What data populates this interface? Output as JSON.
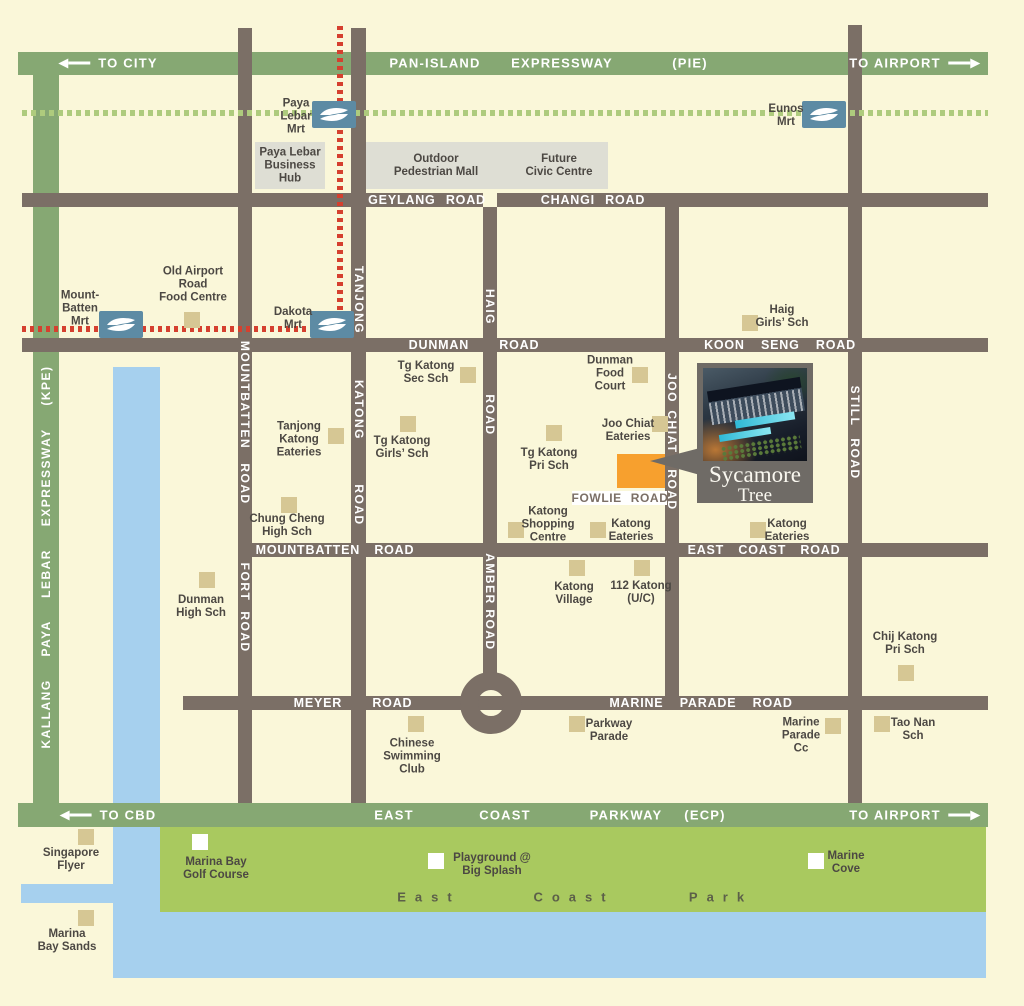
{
  "colors": {
    "background": "#FAF7D9",
    "road": "#7B6F66",
    "expressway_green": "#86A873",
    "mrt_line_green": "#AECB7D",
    "mrt_line_red": "#D5402F",
    "water": "#A6D0EE",
    "park": "#A9C95F",
    "landmark_beige": "#D6C794",
    "site_orange": "#F7A02E",
    "mrt_icon_blue": "#5D8BA4",
    "area_gray": "#DEDED4",
    "callout_gray": "#6F6B66",
    "label_dark": "#4C4843"
  },
  "expressways": {
    "pie": {
      "to_city": "TO CITY",
      "name_a": "PAN-ISLAND",
      "name_b": "EXPRESSWAY",
      "abbr": "(PIE)",
      "to_airport": "TO AIRPORT"
    },
    "ecp": {
      "to_cbd": "TO CBD",
      "name_a": "EAST",
      "name_b": "COAST",
      "name_c": "PARKWAY",
      "abbr": "(ECP)",
      "to_airport": "TO AIRPORT"
    },
    "kpe": {
      "name": "KALLANG PAYA LEBAR EXPRESSWAY (KPE)"
    }
  },
  "roads": {
    "geylang": "GEYLANG ROAD",
    "changi": "CHANGI ROAD",
    "dunman": "DUNMAN ROAD",
    "koon_seng": "KOON SENG ROAD",
    "mountbatten_h": "MOUNTBATTEN ROAD",
    "east_coast": "EAST COAST ROAD",
    "meyer": "MEYER ROAD",
    "marine_parade": "MARINE PARADE ROAD",
    "fowlie": "FOWLIE ROAD",
    "mountbatten_v": [
      "MOUNTBATTEN",
      "ROAD"
    ],
    "fort": [
      "FORT",
      "ROAD"
    ],
    "tanjong_katong": [
      "TANJONG",
      "KATONG",
      "ROAD"
    ],
    "haig": [
      "HAIG",
      "ROAD"
    ],
    "joo_chiat": [
      "JOO",
      "CHIAT",
      "ROAD"
    ],
    "still": [
      "STILL",
      "ROAD"
    ],
    "amber": [
      "AMBER",
      "ROAD"
    ]
  },
  "mrt": {
    "paya_lebar": "Paya\nLebar\nMrt",
    "eunos": "Eunos\nMrt",
    "mountbatten": "Mount-\nBatten\nMrt",
    "dakota": "Dakota\nMrt"
  },
  "areas": {
    "business_hub": "Paya Lebar\nBusiness\nHub",
    "pedestrian_mall": "Outdoor\nPedestrian Mall",
    "civic_centre": "Future\nCivic Centre",
    "park_east": "East",
    "park_coast": "Coast",
    "park_park": "Park"
  },
  "landmarks": {
    "old_airport": "Old Airport\nRoad\nFood Centre",
    "haig_girls": "Haig\nGirls’ Sch",
    "tg_katong_sec": "Tg Katong\nSec Sch",
    "dunman_food_court": "Dunman\nFood\nCourt",
    "tanjong_katong_eateries": "Tanjong\nKatong\nEateries",
    "tg_katong_girls": "Tg Katong\nGirls’ Sch",
    "joo_chiat_eateries": "Joo Chiat\nEateries",
    "tg_katong_pri": "Tg Katong\nPri Sch",
    "chung_cheng": "Chung Cheng\nHigh Sch",
    "katong_shopping": "Katong\nShopping\nCentre",
    "katong_eateries_west": "Katong\nEateries",
    "katong_eateries_east": "Katong\nEateries",
    "dunman_high": "Dunman\nHigh Sch",
    "katong_village": "Katong\nVillage",
    "katong_112": "112 Katong\n(U/C)",
    "chij_katong": "Chij Katong\nPri Sch",
    "chinese_swimming": "Chinese\nSwimming\nClub",
    "parkway_parade": "Parkway\nParade",
    "marine_parade_cc": "Marine\nParade\nCc",
    "tao_nan": "Tao Nan\nSch",
    "singapore_flyer": "Singapore\nFlyer",
    "marina_bay_sands": "Marina\nBay Sands",
    "marina_bay_golf": "Marina Bay\nGolf Course",
    "playground": "Playground @\nBig Splash",
    "marine_cove": "Marine\nCove"
  },
  "callout": {
    "line1": "Sycamore",
    "line2": "Tree"
  }
}
